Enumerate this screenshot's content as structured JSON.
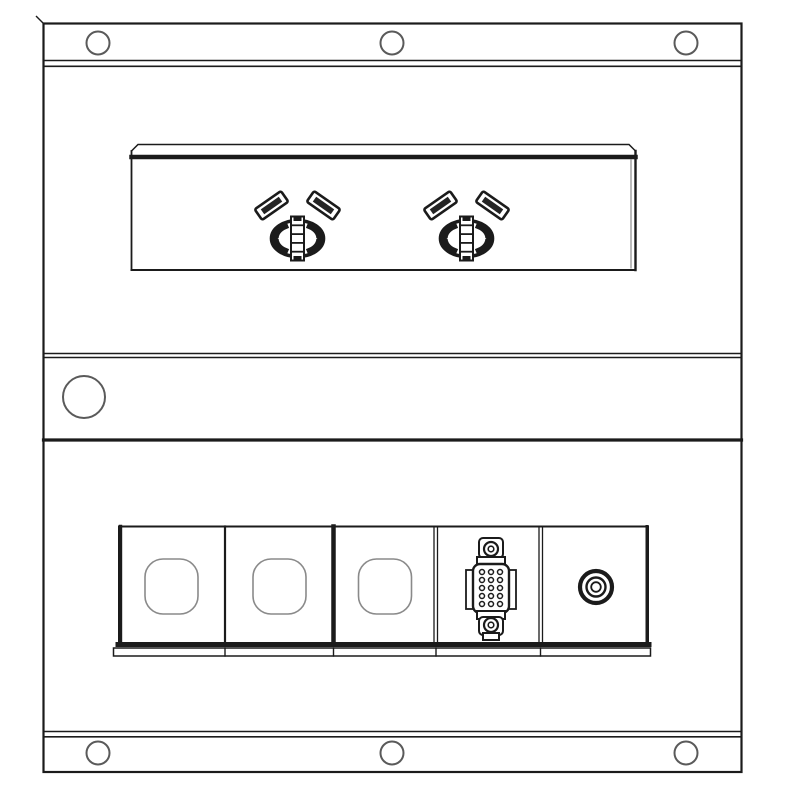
{
  "colors": {
    "background": "#ffffff",
    "line_primary": "#1b1b1b",
    "line_secondary": "#5a5a5a",
    "line_light": "#8a8a8a",
    "fill_dark": "#1b1b1b",
    "fill_white": "#ffffff"
  },
  "panel": {
    "top_screw_holes": 3,
    "bottom_screw_holes": 3,
    "power_outlets": 2,
    "side_access_holes": 1,
    "modules": [
      {
        "position": 1,
        "type": "blank-squircle-cutout"
      },
      {
        "position": 2,
        "type": "blank-squircle-cutout"
      },
      {
        "position": 3,
        "type": "blank-squircle-cutout"
      },
      {
        "position": 4,
        "type": "d-sub-connector"
      },
      {
        "position": 5,
        "type": "rca-jack"
      }
    ]
  }
}
